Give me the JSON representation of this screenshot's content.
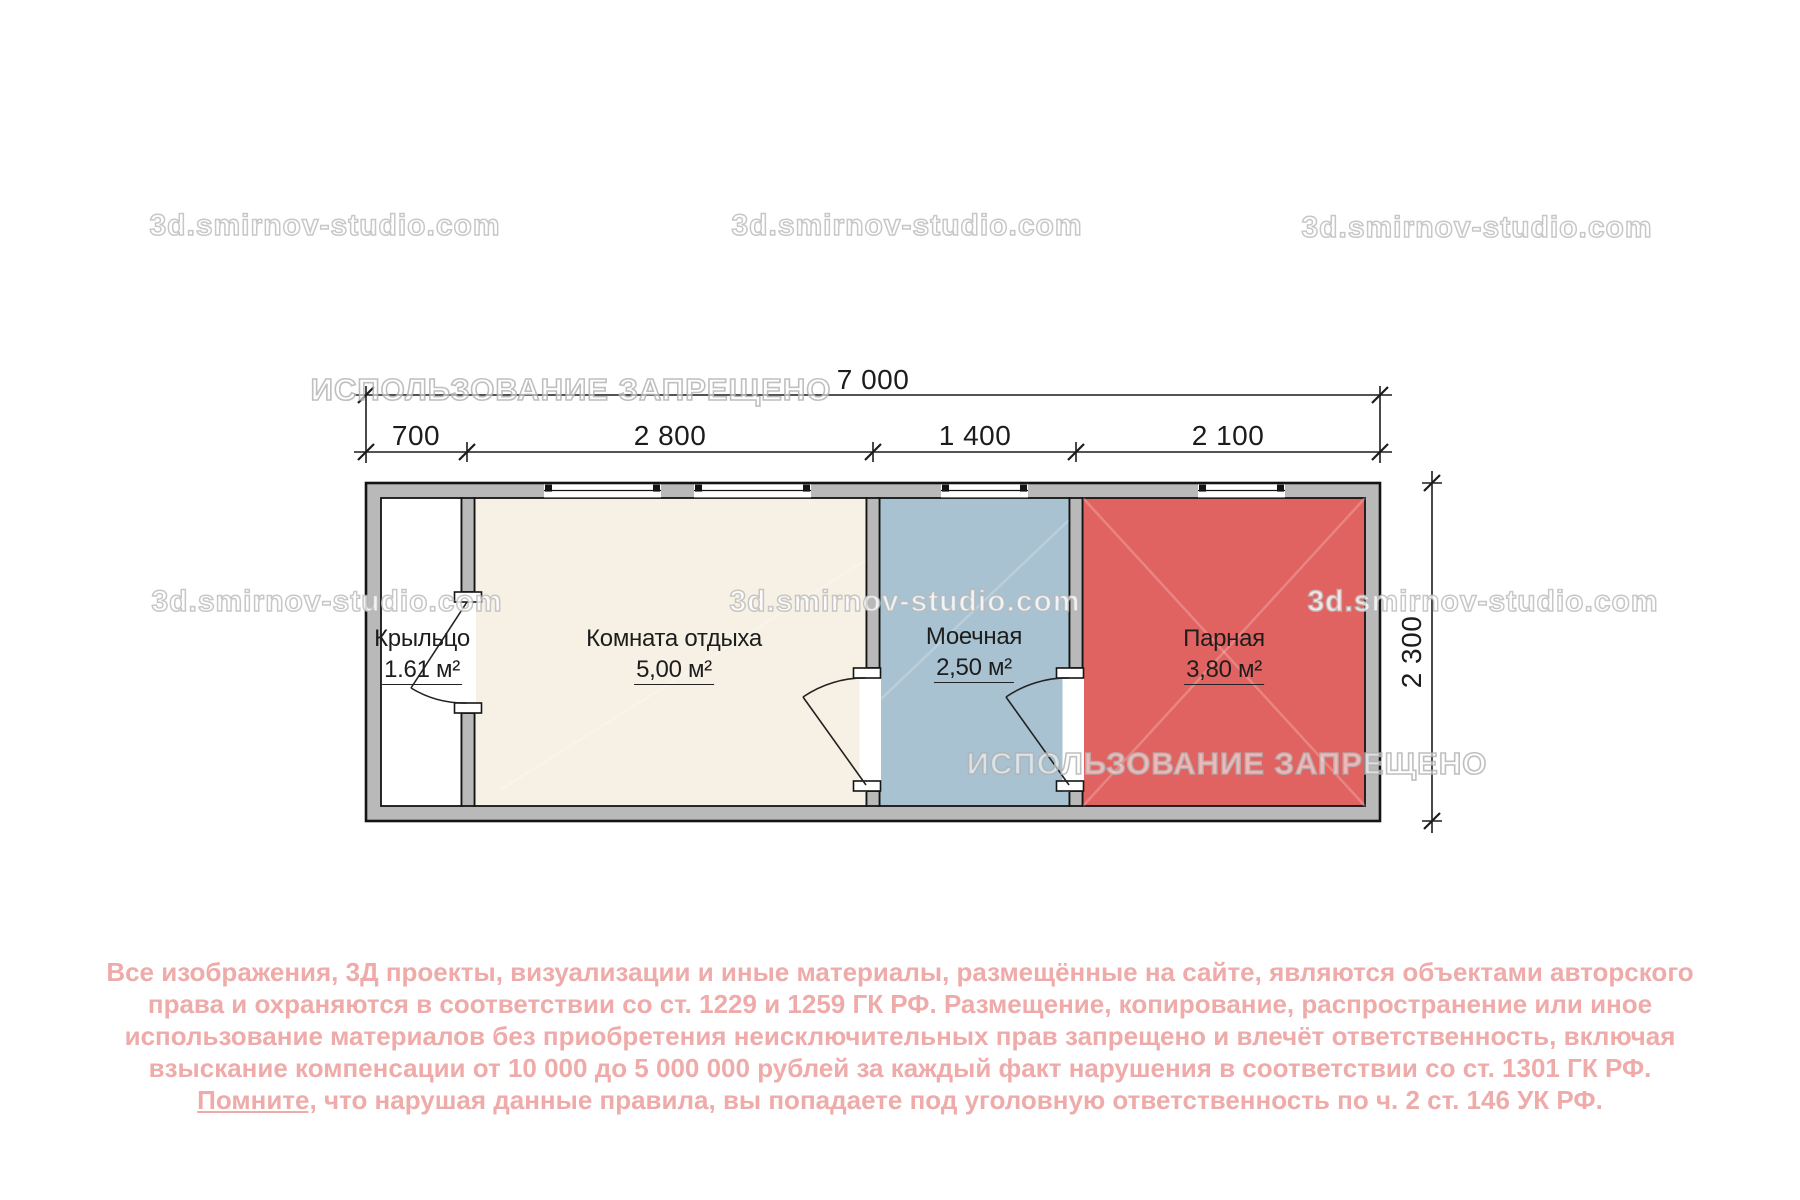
{
  "watermark": {
    "brand": "3d.smirnov-studio.com",
    "forbidden": "ИСПОЛЬЗОВАНИЕ ЗАПРЕЩЕНО"
  },
  "dimensions": {
    "total_width": "7 000",
    "segments": [
      "700",
      "2 800",
      "1 400",
      "2 100"
    ],
    "height": "2 300"
  },
  "rooms": [
    {
      "name": "Крыльцо",
      "area": "1.61 м²",
      "color": "#ffffff"
    },
    {
      "name": "Комната отдыха",
      "area": "5,00 м²",
      "color": "#f6f1e4"
    },
    {
      "name": "Моечная",
      "area": "2,50 м²",
      "color": "#a8c2d1"
    },
    {
      "name": "Парная",
      "area": "3,80 м²",
      "color": "#e06361"
    }
  ],
  "plan_colors": {
    "wall_fill": "#b9b9b9",
    "outline": "#141414",
    "dimension_lines": "#1c1c1c",
    "disclaimer_text": "#eeaba9"
  },
  "disclaimer": {
    "line1": "Все изображения, 3Д проекты, визуализации и иные материалы, размещённые на сайте, являются объектами авторского",
    "line2": "права и охраняются в соответствии со ст. 1229 и 1259 ГК РФ. Размещение, копирование, распространение или иное",
    "line3": "использование материалов без приобретения неисключительных прав запрещено и влечёт ответственность, включая",
    "line4": "взыскание компенсации от 10 000 до 5 000 000 рублей за каждый факт нарушения в соответствии со ст. 1301 ГК РФ.",
    "line5_underlined": "Помните,",
    "line5_rest": "что нарушая данные правила, вы попадаете под уголовную ответственность по ч. 2 ст. 146 УК РФ."
  }
}
